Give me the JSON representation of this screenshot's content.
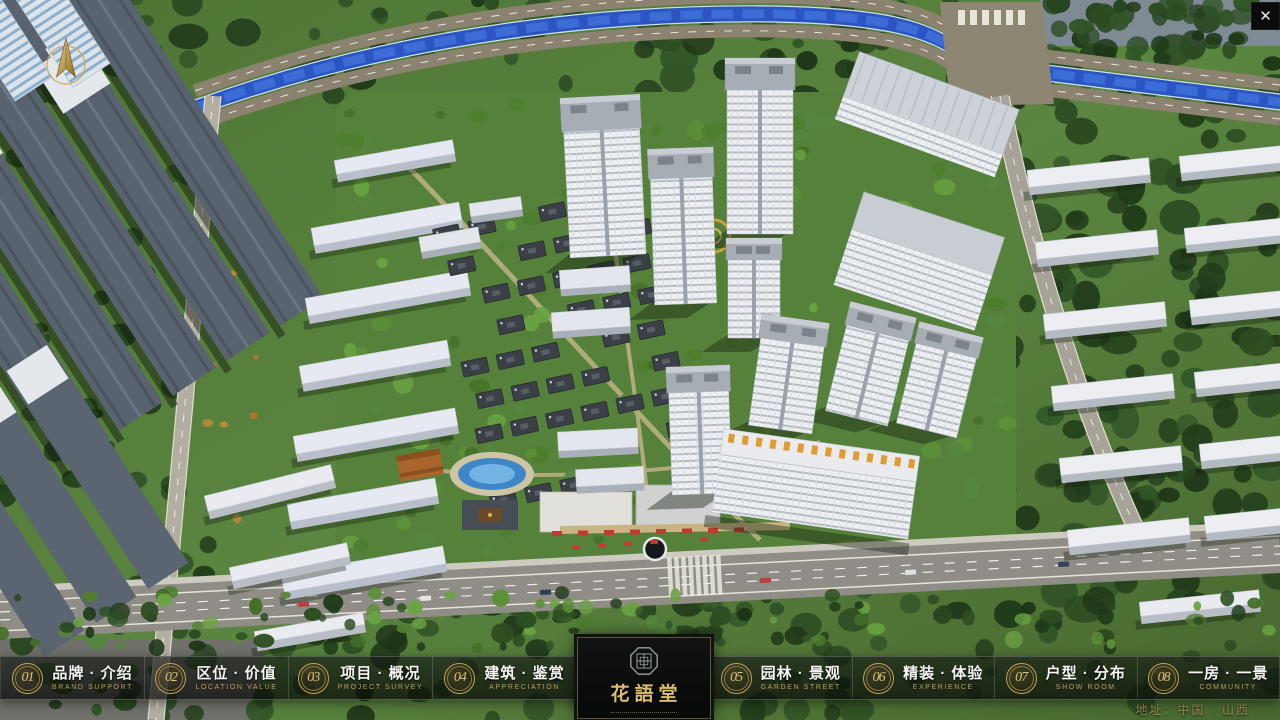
{
  "theme": {
    "accent_gold": "#C9A85C",
    "nav_title_color": "#F5F5F2",
    "nav_subtitle_color": "#BB9F5E",
    "logo_gold": "#D9BB6D",
    "canal_blue": "#2A55C2",
    "bar_background": "rgba(10,14,11,0.68)"
  },
  "viewer": {
    "close_label": "✕"
  },
  "brand": {
    "logo_text": "花語堂"
  },
  "nav": {
    "items": [
      {
        "number": "01",
        "title": "品牌 · 介绍",
        "subtitle": "BRAND SUPPORT"
      },
      {
        "number": "02",
        "title": "区位 · 价值",
        "subtitle": "LOCATION VALUE"
      },
      {
        "number": "03",
        "title": "项目 · 概况",
        "subtitle": "PROJECT SURVEY"
      },
      {
        "number": "04",
        "title": "建筑 · 鉴赏",
        "subtitle": "APPRECIATION"
      },
      {
        "number": "05",
        "title": "园林 · 景观",
        "subtitle": "GARDEN STREET"
      },
      {
        "number": "06",
        "title": "精装 · 体验",
        "subtitle": "EXPERIENCE"
      },
      {
        "number": "07",
        "title": "户型 · 分布",
        "subtitle": "SHOW ROOM"
      },
      {
        "number": "08",
        "title": "一房 · 一景",
        "subtitle": "COMMUNITY"
      }
    ]
  },
  "footer": {
    "address": "地址：中国 · 山西"
  }
}
